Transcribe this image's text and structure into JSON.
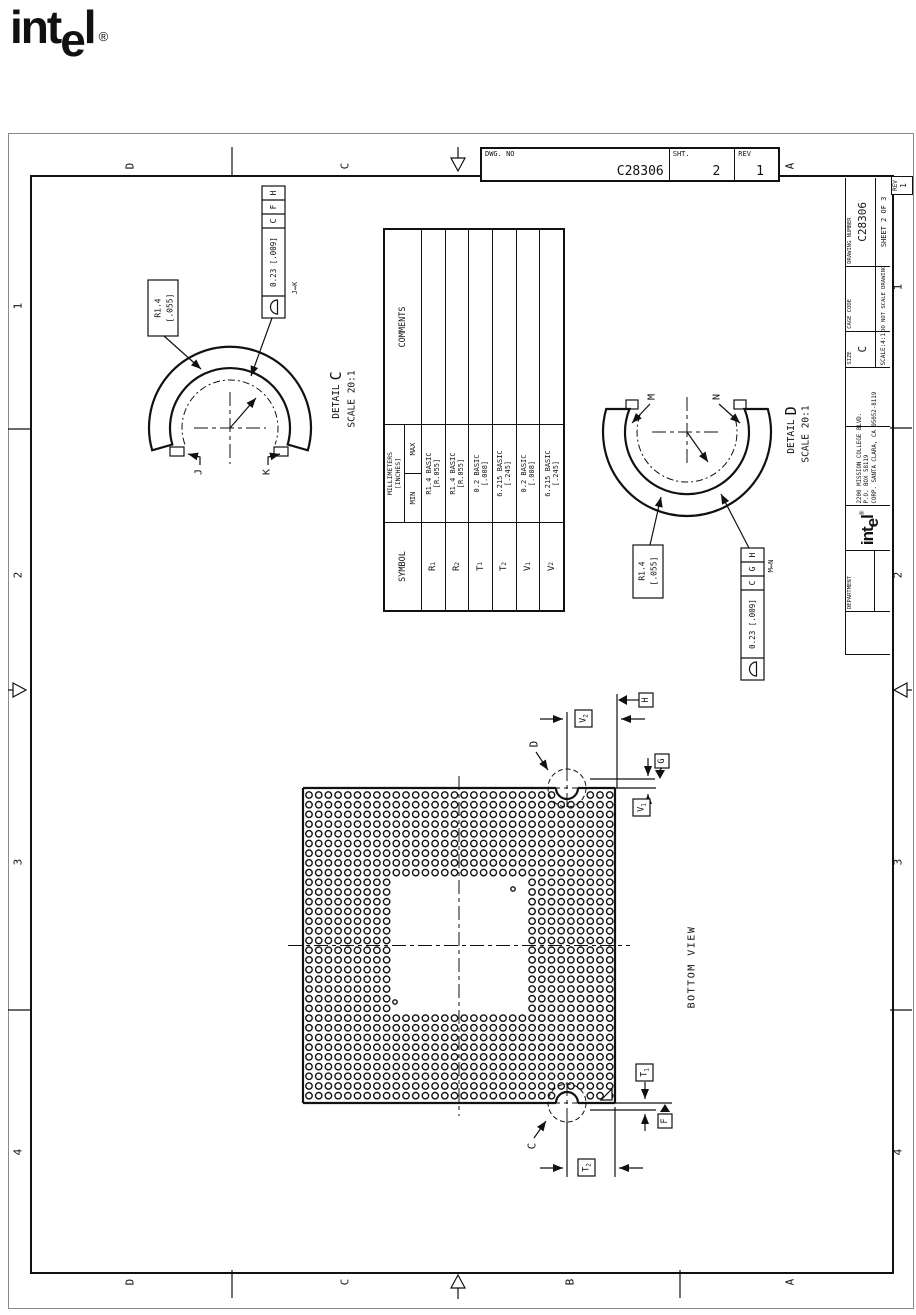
{
  "page": {
    "ink": "#111111",
    "paper": "#ffffff"
  },
  "logo": {
    "part1": "int",
    "part2": "e",
    "part3": "l",
    "reg": "®"
  },
  "zones": {
    "top": [
      "D",
      "C",
      "A"
    ],
    "bottom": [
      "D",
      "C",
      "B",
      "A"
    ],
    "left": [
      "1",
      "2",
      "3",
      "4"
    ],
    "right": [
      "1",
      "2",
      "3",
      "4"
    ]
  },
  "dwg_block": {
    "no_label": "DWG. NO",
    "no_value": "C28306",
    "sht_label": "SHT.",
    "sht_value": "2",
    "rev_label": "REV",
    "rev_value": "1"
  },
  "rev_box": {
    "label": "REV",
    "value": "1"
  },
  "title_block": {
    "department": "DEPARTMENT",
    "brand": {
      "part1": "int",
      "part2": "e",
      "part3": "l",
      "reg": "®"
    },
    "address1": "2200 MISSION COLLEGE BLVD.",
    "address2": "P.O. BOX 58119",
    "address3": "CORP. SANTA CLARA, CA 95052-8119",
    "size_label": "SIZE",
    "size_value": "C",
    "cage_label": "CAGE CODE",
    "dwg_label": "DRAWING NUMBER",
    "dwg_value": "C28306",
    "scale": "SCALE:4:1",
    "no_scale": "DO NOT SCALE DRAWING",
    "sheet": "SHEET 2 OF 3"
  },
  "sym_table": {
    "symbol_header": "SYMBOL",
    "mm_header": "MILLIMETERS",
    "in_header": "[INCHES]",
    "min": "MIN",
    "max": "MAX",
    "comments": "COMMENTS",
    "rows": [
      {
        "s": "R",
        "sub": "1",
        "l1": "R1.4 BASIC",
        "l2": "[R.055]"
      },
      {
        "s": "R",
        "sub": "2",
        "l1": "R1.4 BASIC",
        "l2": "[R.055]"
      },
      {
        "s": "T",
        "sub": "1",
        "l1": "0.2 BASIC",
        "l2": "[.008]"
      },
      {
        "s": "T",
        "sub": "2",
        "l1": "6.215 BASIC",
        "l2": "[.245]"
      },
      {
        "s": "V",
        "sub": "1",
        "l1": "0.2 BASIC",
        "l2": "[.008]"
      },
      {
        "s": "V",
        "sub": "2",
        "l1": "6.215 BASIC",
        "l2": "[.245]"
      }
    ]
  },
  "detail_c": {
    "title": "DETAIL",
    "letter": "C",
    "scale": "SCALE 20:1",
    "radius": "R1.4",
    "radius_in": "[.055]",
    "fcf_tol": "0.23 [.009]",
    "fcf_d1": "C",
    "fcf_d2": "F",
    "fcf_d3": "H",
    "between": "J↔K",
    "end1": "J",
    "end2": "K"
  },
  "detail_d": {
    "title": "DETAIL",
    "letter": "D",
    "scale": "SCALE 20:1",
    "radius": "R1.4",
    "radius_in": "[.055]",
    "fcf_tol": "0.23 [.009]",
    "fcf_d1": "C",
    "fcf_d2": "G",
    "fcf_d3": "H",
    "between": "M↔N",
    "end1": "M",
    "end2": "N"
  },
  "bga": {
    "caption": "BOTTOM VIEW",
    "labels": {
      "d": "D",
      "c": "C",
      "h": "H",
      "g": "G",
      "f": "F",
      "v1b": "V",
      "v1s": "1",
      "v2b": "V",
      "v2s": "2",
      "t1b": "T",
      "t1s": "1",
      "t2b": "T",
      "t2s": "2"
    },
    "grid": {
      "x0": 309,
      "y0": 795,
      "cols": 32,
      "rows": 32,
      "pitch": 9.7,
      "r": 3.2,
      "void_c1": 9,
      "void_c2": 22,
      "void_r1": 9,
      "void_r2": 22,
      "notch_clear": 16,
      "notches": [
        {
          "x": 567,
          "y": 788
        },
        {
          "x": 567,
          "y": 1103
        }
      ]
    }
  }
}
